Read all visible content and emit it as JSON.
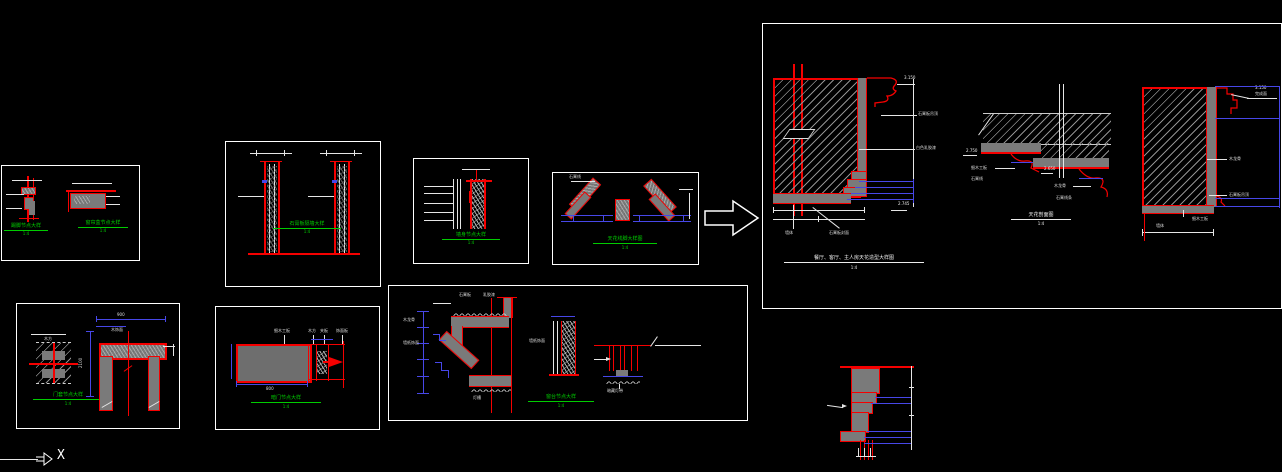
{
  "colors": {
    "red": "#f50000",
    "gray": "#7a7a7a",
    "blue": "#4747e8",
    "green": "#00cc00",
    "hatch": "#8f8f8f",
    "white": "#ffffff",
    "background": "#000000"
  },
  "ucs": {
    "x": "X"
  },
  "boxes": {
    "a": {
      "d1_title": "踢脚节点大样",
      "d1_scale": "1:4",
      "d2_title": "窗帘盒节点大样",
      "d2_scale": "1:4"
    },
    "b": {
      "title": "石膏板隔墙大样",
      "scale": "1:4"
    },
    "c": {
      "title": "墙身节点大样",
      "scale": "1:4"
    },
    "d": {
      "title": "天花线脚大样图",
      "scale": "1:4",
      "label": "石膏线"
    },
    "e": {
      "title": "餐厅、客厅、主人房天花造型大样图",
      "scale": "1:4",
      "level_top": "3.150",
      "level_bottom": "2.745",
      "label_board": "石膏板吊顶",
      "label_paint": "白色乳胶漆",
      "label_wall": "墙体",
      "label_face": "石膏板封面",
      "mid": {
        "title": "天花剖面图",
        "scale": "1:4",
        "level_left": "2.750",
        "level_right": "2.650",
        "labels": [
          "细木工板",
          "石膏线",
          "木龙骨",
          "石膏线条"
        ]
      },
      "right": {
        "level": "3.150",
        "level_sub": "完成面",
        "labels": [
          "木龙骨",
          "石膏板吊顶",
          "细木工板",
          "墙体"
        ]
      }
    },
    "f": {
      "title": "门套节点大样",
      "scale": "1:4",
      "label": "木方",
      "label2": "木饰面",
      "dim_top": "900",
      "dim_left": "2100"
    },
    "g": {
      "title": "暗门节点大样",
      "scale": "1:4",
      "labels": [
        "细木工板",
        "木方",
        "夹板",
        "饰面板"
      ],
      "dim": "800"
    },
    "h": {
      "title": "窗台节点大样",
      "scale": "1:4",
      "labels": [
        "石膏板",
        "乳胶漆",
        "木龙骨",
        "墙纸饰面",
        "暗藏灯带",
        "灯槽"
      ]
    }
  }
}
